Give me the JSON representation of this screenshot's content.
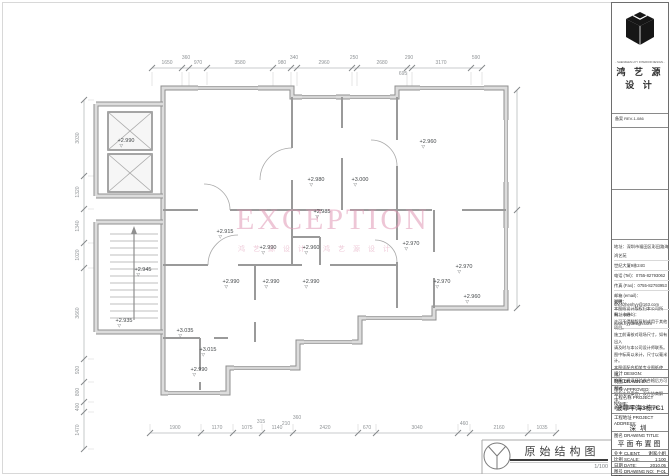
{
  "sheet": {
    "watermark": {
      "text": "EXCEPTION",
      "sub": "鸿艺源设计 鸿艺源设计",
      "color": "#e098b4"
    },
    "stamp": {
      "title": "原始结构图",
      "scale": "1/100"
    }
  },
  "title_block": {
    "tagline": "- SHENZHEN HYY INTERIOR DESIGN -",
    "brand": "鸿 艺 源 设 计",
    "reg_row": "备案 REV-1-086",
    "contact": [
      "地址：深圳市福田区彩田路海鸿艺苑",
      "世纪大厦9栋24G",
      "电话 (Tel)：0755-82793062",
      "传真 (Fax)：0755-82793953",
      "邮箱 (email)：shenzhenhyy@163.com",
      "网址 (Web)：www.hyydesign.com"
    ],
    "notes_title": "说明：",
    "notes": [
      "本图纸设计版权归本公司所有，未经",
      "许可不得翻版复制或用于其他项目。",
      "施工前请核对现场尺寸，如有出入",
      "请及时与本公司设计师联系。",
      "图中标高以米计，尺寸以毫米计。",
      "本图须配合相关专业图纸使用。",
      "隐蔽工程须经验收合格后方可封闭。",
      "如有未尽事宜，双方协商解决。",
      "最终解释权归本公司所有。"
    ],
    "sign_rows": [
      "设计 DESIGN:",
      "制图 DRAWN BY:",
      "审核 APPROVED:"
    ],
    "project_name_label": "工程名称 PROJECT NAME:",
    "project_name": "波菲平海3栋7C1",
    "project_address_label": "工程地址 PROJECT ADDRESS:",
    "project_address": "深圳",
    "drawing_title_label": "图名 DRAWING TITLE:",
    "drawing_title": "平面布置图",
    "client_label": "业主 CLIENT:",
    "client": "谢家小姐",
    "scale_label": "比例 SCALE:",
    "scale": "1:100",
    "date_label": "日期 DATE:",
    "date": "2010.05",
    "no_label": "图号 DRAWING NO:",
    "no": "P-01",
    "page_label": "页数",
    "page": "01"
  },
  "dims": {
    "labels": [
      {
        "t": "1650",
        "x": 167,
        "y": 63
      },
      {
        "t": "360",
        "x": 186,
        "y": 58
      },
      {
        "t": "970",
        "x": 198,
        "y": 63
      },
      {
        "t": "3580",
        "x": 240,
        "y": 63
      },
      {
        "t": "980",
        "x": 282,
        "y": 63
      },
      {
        "t": "340",
        "x": 294,
        "y": 58
      },
      {
        "t": "2960",
        "x": 324,
        "y": 63
      },
      {
        "t": "250",
        "x": 354,
        "y": 58
      },
      {
        "t": "2680",
        "x": 382,
        "y": 63
      },
      {
        "t": "290",
        "x": 409,
        "y": 58
      },
      {
        "t": "3170",
        "x": 441,
        "y": 63
      },
      {
        "t": "590",
        "x": 476,
        "y": 58
      },
      {
        "t": "695",
        "x": 403,
        "y": 74
      },
      {
        "t": "1900",
        "x": 175,
        "y": 428
      },
      {
        "t": "1170",
        "x": 217,
        "y": 428
      },
      {
        "t": "1075",
        "x": 247,
        "y": 428
      },
      {
        "t": "1140",
        "x": 277,
        "y": 428
      },
      {
        "t": "2420",
        "x": 325,
        "y": 428
      },
      {
        "t": "670",
        "x": 367,
        "y": 428
      },
      {
        "t": "3040",
        "x": 417,
        "y": 428
      },
      {
        "t": "460",
        "x": 464,
        "y": 424
      },
      {
        "t": "2160",
        "x": 499,
        "y": 428
      },
      {
        "t": "1035",
        "x": 542,
        "y": 428
      },
      {
        "t": "315",
        "x": 261,
        "y": 422
      },
      {
        "t": "210",
        "x": 286,
        "y": 424
      },
      {
        "t": "360",
        "x": 297,
        "y": 418
      },
      {
        "t": "3030",
        "x": 78,
        "y": 138,
        "r": -90
      },
      {
        "t": "1320",
        "x": 78,
        "y": 192,
        "r": -90
      },
      {
        "t": "1340",
        "x": 78,
        "y": 226,
        "r": -90
      },
      {
        "t": "1020",
        "x": 78,
        "y": 255,
        "r": -90
      },
      {
        "t": "3660",
        "x": 78,
        "y": 313,
        "r": -90
      },
      {
        "t": "920",
        "x": 78,
        "y": 370,
        "r": -90
      },
      {
        "t": "800",
        "x": 78,
        "y": 392,
        "r": -90
      },
      {
        "t": "400",
        "x": 78,
        "y": 407,
        "r": -90
      },
      {
        "t": "1470",
        "x": 78,
        "y": 430,
        "r": -90
      }
    ]
  },
  "elevations": [
    {
      "t": "+2.990",
      "x": 126,
      "y": 141
    },
    {
      "t": "+2.960",
      "x": 428,
      "y": 142
    },
    {
      "t": "+2.980",
      "x": 316,
      "y": 180
    },
    {
      "t": "+3.000",
      "x": 360,
      "y": 180
    },
    {
      "t": "+2.985",
      "x": 322,
      "y": 212
    },
    {
      "t": "+2.915",
      "x": 225,
      "y": 232
    },
    {
      "t": "+2.990",
      "x": 268,
      "y": 248
    },
    {
      "t": "+2.960",
      "x": 311,
      "y": 248
    },
    {
      "t": "+2.970",
      "x": 411,
      "y": 244
    },
    {
      "t": "+2.970",
      "x": 464,
      "y": 267
    },
    {
      "t": "+2.945",
      "x": 143,
      "y": 270
    },
    {
      "t": "+2.990",
      "x": 231,
      "y": 282
    },
    {
      "t": "+2.990",
      "x": 271,
      "y": 282
    },
    {
      "t": "+2.990",
      "x": 311,
      "y": 282
    },
    {
      "t": "+2.970",
      "x": 442,
      "y": 282
    },
    {
      "t": "+2.960",
      "x": 472,
      "y": 297
    },
    {
      "t": "+2.935",
      "x": 124,
      "y": 321
    },
    {
      "t": "+3.035",
      "x": 185,
      "y": 331
    },
    {
      "t": "+3.015",
      "x": 208,
      "y": 350
    },
    {
      "t": "+2.990",
      "x": 199,
      "y": 370
    }
  ]
}
